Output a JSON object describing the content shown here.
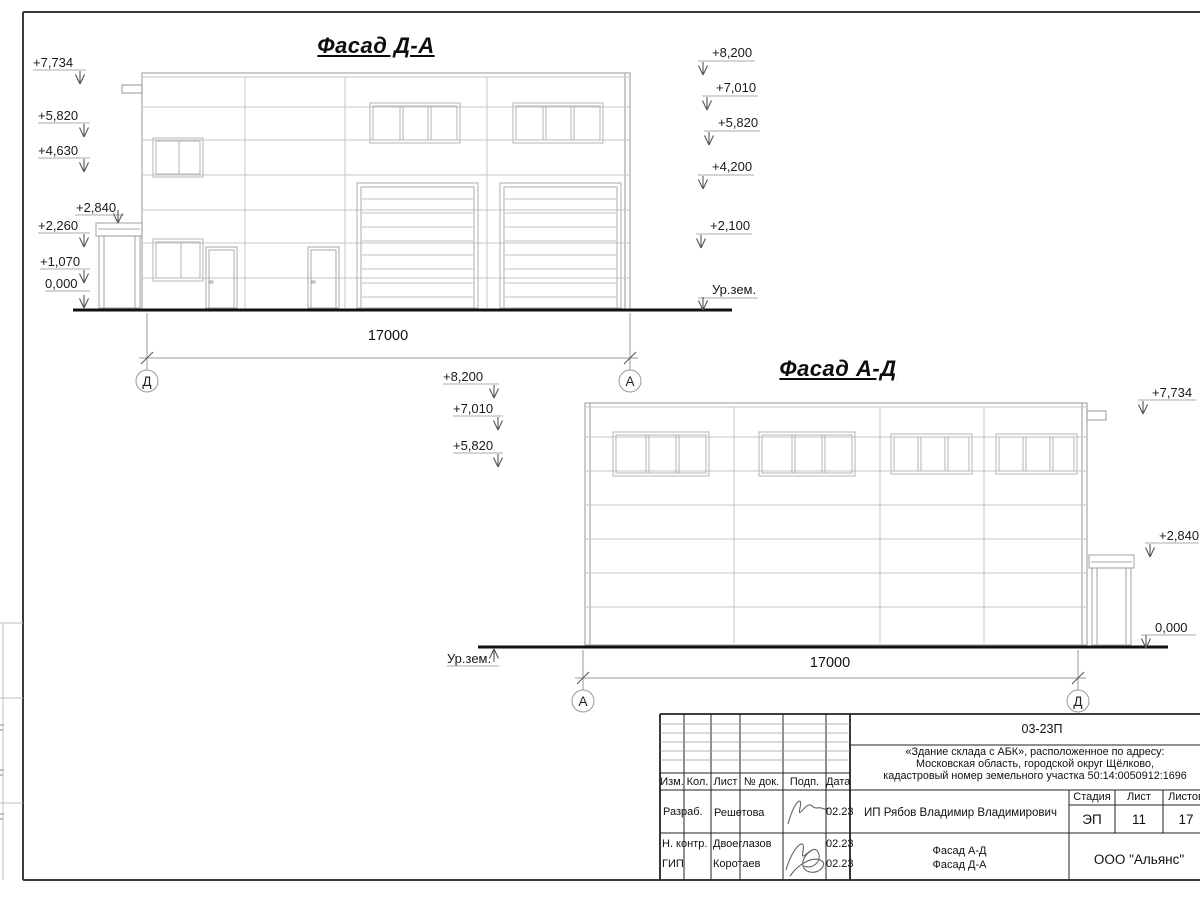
{
  "facade_da": {
    "title": "Фасад Д-А",
    "dimension": "17000",
    "axis_left": "Д",
    "axis_right": "А",
    "elevations_left": [
      "+7,734",
      "+5,820",
      "+4,630",
      "+2,840",
      "+2,260",
      "+1,070",
      "0,000"
    ],
    "elevations_right": [
      "+8,200",
      "+7,010",
      "+5,820",
      "+4,200",
      "+2,100",
      "Ур.зем."
    ]
  },
  "facade_ad": {
    "title": "Фасад А-Д",
    "dimension": "17000",
    "axis_left": "А",
    "axis_right": "Д",
    "elevations_left": [
      "+8,200",
      "+7,010",
      "+5,820"
    ],
    "ground_label": "Ур.зем.",
    "elevations_right": [
      "+7,734",
      "+2,840",
      "0,000"
    ]
  },
  "title_block": {
    "doc_number": "03-23П",
    "description_line1": "«Здание склада с АБК», расположенное по адресу:",
    "description_line2": "Московская область, городской округ Щёлково,",
    "description_line3": "кадастровый номер земельного участка 50:14:0050912:1696",
    "col_izm": "Изм.",
    "col_kol": "Кол.",
    "col_list": "Лист",
    "col_doc": "№ док.",
    "col_podp": "Подп.",
    "col_data": "Дата",
    "row1_role": "Разраб.",
    "row1_name": "Решетова",
    "row1_date": "02.23",
    "row2_role": "Н. контр.",
    "row2_name": "Двоеглазов",
    "row2_date": "02.23",
    "row3_role": "ГИП",
    "row3_name": "Коротаев",
    "row3_date": "02.23",
    "client": "ИП Рябов Владимир Владимирович",
    "stage_header": "Стадия",
    "sheet_header": "Лист",
    "sheets_header": "Листов",
    "stage": "ЭП",
    "sheet": "11",
    "sheets": "17",
    "sheet_title_line1": "Фасад А-Д",
    "sheet_title_line2": "Фасад Д-А",
    "organization": "ООО \"Альянс\""
  }
}
